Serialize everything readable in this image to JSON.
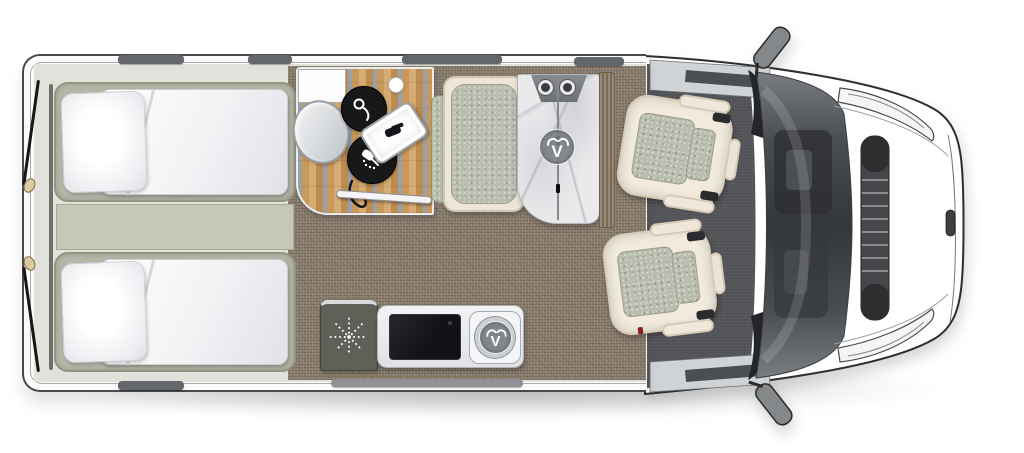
{
  "brand": {
    "logo_letter": "V"
  },
  "palette": {
    "body_outline": "#3d3d3d",
    "wall_white": "#fbfbfc",
    "window_bar": "#63666a",
    "living_carpet": "#8b7e6e",
    "cab_carpet": "#56575a",
    "bed_base": "#b4b7a7",
    "bedding_white": "#f6f6f8",
    "wet_room_wood": "#c9995c",
    "wet_room_stripe": "#9aa1ab",
    "fixture_black": "#17181a",
    "upholstery_cream": "#f1eadd",
    "cushion_sage": "#b9bdae",
    "marble": "#eaeaec",
    "wood_panel": "#8b7a64",
    "windshield_glass": "#33363b"
  },
  "icons": [
    {
      "name": "brand-logo",
      "glyph": "V"
    },
    {
      "name": "shower-mixer-icon"
    },
    {
      "name": "shower-head-icon"
    },
    {
      "name": "heater-fan-icon"
    },
    {
      "name": "hob-burner-icon"
    },
    {
      "name": "wing-mirror-icon"
    }
  ]
}
